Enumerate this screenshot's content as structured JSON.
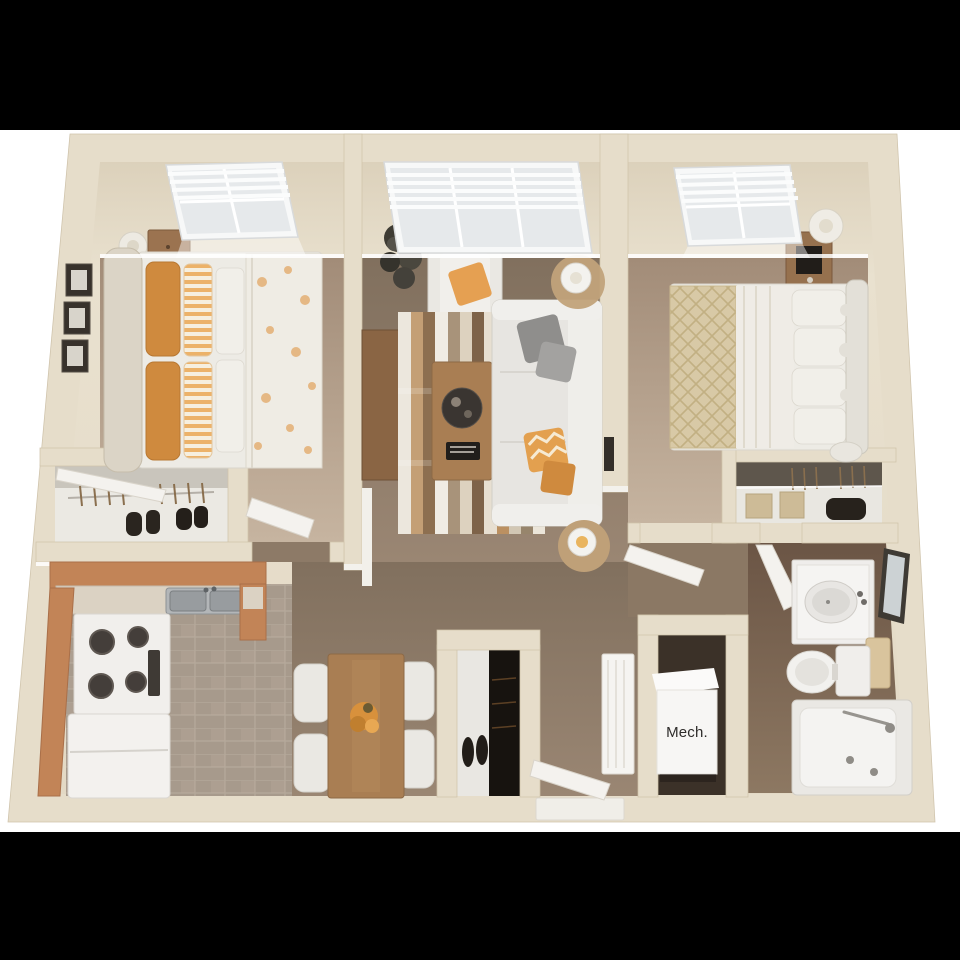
{
  "labels": {
    "mech_closet": "Mech."
  },
  "palette": {
    "letterbox": "#000000",
    "background": "#ffffff",
    "wall_cream": "#e6ddca",
    "wall_edge": "#cfc3ab",
    "bedroom_floor_top": "#a28c78",
    "bedroom_floor_bottom": "#c6b4a0",
    "carpet_top": "#81705e",
    "carpet_bottom": "#9a8673",
    "kitchen_tile": "#a79a8c",
    "kitchen_cabinet": "#c28457",
    "kitchen_counter": "#dbd2c3",
    "bath_floor_top": "#6b5545",
    "bath_floor_bottom": "#8d7862",
    "furniture_white": "#eae8e3",
    "wood": "#a97e53",
    "wood_dark": "#8a6544",
    "accent_orange": "#e5a052",
    "accent_orange_deep": "#cf8a3e",
    "gray_pillow": "#8f8e8c",
    "tan_blanket": "#d8c9a6",
    "dark_item": "#26221e",
    "door_white": "#f4f2ee",
    "mech_box": "#f7f6f4",
    "label_text": "#2e2c2a",
    "window_pane": "#e6e9eb",
    "window_frame": "#f7f8f8"
  }
}
